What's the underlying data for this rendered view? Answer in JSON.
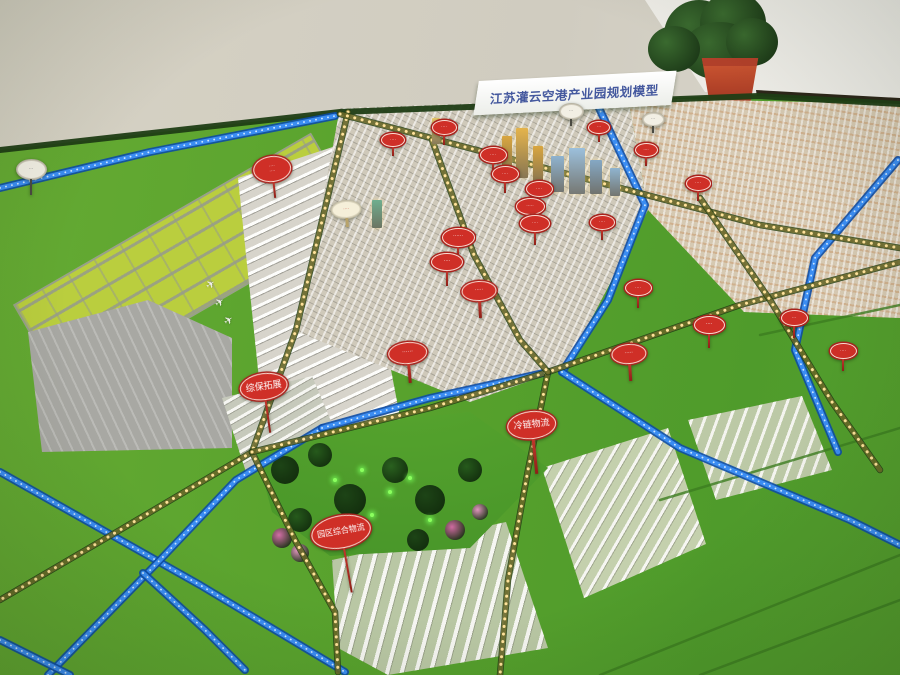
{
  "title_board": {
    "text": "江苏灌云空港产业园规划模型"
  },
  "colors": {
    "grass": "#57a12c",
    "runway_infield": "#bace3e",
    "apron": "#a8a8a3",
    "river_blue": "#3b8df2",
    "road_lights": "#ffe29a",
    "sign_red": "#cf2f27",
    "title_blue": "#44589e",
    "wall": "#d6d2c4",
    "plant_pot": "#b2402a"
  },
  "signs": [
    {
      "x": 272,
      "y": 168,
      "w": 36,
      "h": 24,
      "post": 16,
      "tilt": -6,
      "fs": 4.5,
      "style": "red",
      "text": "····\n····"
    },
    {
      "x": 392,
      "y": 139,
      "w": 22,
      "h": 12,
      "post": 9,
      "tilt": 0,
      "fs": 4.5,
      "style": "red",
      "text": "····"
    },
    {
      "x": 443,
      "y": 126,
      "w": 23,
      "h": 13,
      "post": 10,
      "tilt": 0,
      "fs": 4.5,
      "style": "red",
      "text": "····"
    },
    {
      "x": 492,
      "y": 154,
      "w": 25,
      "h": 14,
      "post": 11,
      "tilt": 0,
      "fs": 4.5,
      "style": "red",
      "text": "····"
    },
    {
      "x": 504,
      "y": 173,
      "w": 25,
      "h": 14,
      "post": 11,
      "tilt": 0,
      "fs": 4.5,
      "style": "red",
      "text": "····"
    },
    {
      "x": 538,
      "y": 188,
      "w": 25,
      "h": 14,
      "post": 10,
      "tilt": 0,
      "fs": 4.5,
      "style": "red",
      "text": "····"
    },
    {
      "x": 529,
      "y": 205,
      "w": 27,
      "h": 15,
      "post": 12,
      "tilt": 0,
      "fs": 4.5,
      "style": "red",
      "text": "·····"
    },
    {
      "x": 534,
      "y": 222,
      "w": 28,
      "h": 15,
      "post": 13,
      "tilt": 0,
      "fs": 4.5,
      "style": "red",
      "text": "····"
    },
    {
      "x": 457,
      "y": 236,
      "w": 31,
      "h": 17,
      "post": 15,
      "tilt": 0,
      "fs": 5,
      "style": "red",
      "text": "······"
    },
    {
      "x": 446,
      "y": 261,
      "w": 30,
      "h": 16,
      "post": 15,
      "tilt": 0,
      "fs": 5,
      "style": "red",
      "text": "····"
    },
    {
      "x": 478,
      "y": 290,
      "w": 33,
      "h": 18,
      "post": 17,
      "tilt": -3,
      "fs": 5,
      "style": "red",
      "text": "·····"
    },
    {
      "x": 407,
      "y": 352,
      "w": 37,
      "h": 20,
      "post": 19,
      "tilt": -5,
      "fs": 5.5,
      "style": "red",
      "text": "······"
    },
    {
      "x": 598,
      "y": 126,
      "w": 20,
      "h": 11,
      "post": 8,
      "tilt": 0,
      "fs": 4,
      "style": "red",
      "text": "···"
    },
    {
      "x": 645,
      "y": 149,
      "w": 21,
      "h": 12,
      "post": 9,
      "tilt": 0,
      "fs": 4,
      "style": "red",
      "text": "····"
    },
    {
      "x": 697,
      "y": 182,
      "w": 23,
      "h": 13,
      "post": 10,
      "tilt": 0,
      "fs": 4.5,
      "style": "red",
      "text": "····"
    },
    {
      "x": 601,
      "y": 221,
      "w": 23,
      "h": 13,
      "post": 10,
      "tilt": 0,
      "fs": 4.5,
      "style": "red",
      "text": "····"
    },
    {
      "x": 637,
      "y": 287,
      "w": 25,
      "h": 14,
      "post": 12,
      "tilt": 0,
      "fs": 4.5,
      "style": "red",
      "text": "····"
    },
    {
      "x": 628,
      "y": 353,
      "w": 33,
      "h": 18,
      "post": 17,
      "tilt": -4,
      "fs": 5,
      "style": "red",
      "text": "·····"
    },
    {
      "x": 708,
      "y": 324,
      "w": 29,
      "h": 16,
      "post": 14,
      "tilt": 0,
      "fs": 5,
      "style": "red",
      "text": "····"
    },
    {
      "x": 793,
      "y": 317,
      "w": 25,
      "h": 14,
      "post": 12,
      "tilt": 0,
      "fs": 4.5,
      "style": "red",
      "text": "···"
    },
    {
      "x": 842,
      "y": 350,
      "w": 25,
      "h": 14,
      "post": 12,
      "tilt": 0,
      "fs": 4.5,
      "style": "red",
      "text": "····"
    },
    {
      "x": 265,
      "y": 385,
      "w": 46,
      "h": 25,
      "post": 33,
      "tilt": -8,
      "fs": 9,
      "style": "red",
      "text": "综保拓展"
    },
    {
      "x": 532,
      "y": 424,
      "w": 47,
      "h": 26,
      "post": 35,
      "tilt": -6,
      "fs": 9,
      "style": "red",
      "text": "冷链物流"
    },
    {
      "x": 344,
      "y": 530,
      "w": 58,
      "h": 31,
      "post": 45,
      "tilt": -10,
      "fs": 8,
      "style": "red",
      "text": "园区综合物流"
    },
    {
      "x": 30,
      "y": 168,
      "w": 27,
      "h": 17,
      "post": 16,
      "tilt": 0,
      "fs": 4.5,
      "style": "pale",
      "text": "···"
    },
    {
      "x": 345,
      "y": 208,
      "w": 27,
      "h": 15,
      "post": 9,
      "tilt": -4,
      "fs": 4.5,
      "style": "pale-red",
      "text": "····"
    },
    {
      "x": 570,
      "y": 110,
      "w": 21,
      "h": 13,
      "post": 7,
      "tilt": 0,
      "fs": 4,
      "style": "pale",
      "text": "···"
    },
    {
      "x": 652,
      "y": 118,
      "w": 19,
      "h": 11,
      "post": 7,
      "tilt": 0,
      "fs": 4,
      "style": "pale",
      "text": "···"
    }
  ],
  "towers": [
    {
      "x": 502,
      "y": 136,
      "w": 10,
      "h": 40,
      "c": "#d9a63f"
    },
    {
      "x": 516,
      "y": 128,
      "w": 12,
      "h": 50,
      "c": "#e5b44c"
    },
    {
      "x": 533,
      "y": 146,
      "w": 10,
      "h": 38,
      "c": "#d9a63f"
    },
    {
      "x": 432,
      "y": 118,
      "w": 8,
      "h": 26,
      "c": "#e8c86a"
    },
    {
      "x": 372,
      "y": 200,
      "w": 10,
      "h": 28,
      "c": "#6fae8f"
    },
    {
      "x": 551,
      "y": 156,
      "w": 13,
      "h": 36,
      "c": "#8fb3cf"
    },
    {
      "x": 569,
      "y": 148,
      "w": 16,
      "h": 46,
      "c": "#9cc0dc"
    },
    {
      "x": 590,
      "y": 160,
      "w": 12,
      "h": 34,
      "c": "#85a8c4"
    },
    {
      "x": 610,
      "y": 168,
      "w": 10,
      "h": 28,
      "c": "#90b4cf"
    }
  ],
  "planes": [
    {
      "x": 206,
      "y": 278
    },
    {
      "x": 215,
      "y": 296
    },
    {
      "x": 224,
      "y": 314
    }
  ],
  "park": {
    "trees": [
      {
        "x": 285,
        "y": 470,
        "r": 14,
        "c": "#1d4416"
      },
      {
        "x": 320,
        "y": 455,
        "r": 12,
        "c": "#265a1c"
      },
      {
        "x": 350,
        "y": 500,
        "r": 16,
        "c": "#1d4416"
      },
      {
        "x": 395,
        "y": 470,
        "r": 13,
        "c": "#2a611f"
      },
      {
        "x": 430,
        "y": 500,
        "r": 15,
        "c": "#1d4416"
      },
      {
        "x": 470,
        "y": 470,
        "r": 12,
        "c": "#265a1c"
      },
      {
        "x": 300,
        "y": 520,
        "r": 12,
        "c": "#265a1c"
      },
      {
        "x": 418,
        "y": 540,
        "r": 11,
        "c": "#1d4416"
      },
      {
        "x": 282,
        "y": 538,
        "r": 10,
        "c": "#d36fa6"
      },
      {
        "x": 300,
        "y": 553,
        "r": 9,
        "c": "#e196be"
      },
      {
        "x": 455,
        "y": 530,
        "r": 10,
        "c": "#cf6ba1"
      },
      {
        "x": 480,
        "y": 512,
        "r": 8,
        "c": "#e196be"
      }
    ],
    "lights": [
      {
        "x": 335,
        "y": 480
      },
      {
        "x": 362,
        "y": 470
      },
      {
        "x": 390,
        "y": 492
      },
      {
        "x": 372,
        "y": 515
      },
      {
        "x": 410,
        "y": 478
      },
      {
        "x": 430,
        "y": 520
      },
      {
        "x": 352,
        "y": 535
      }
    ]
  },
  "roads": {
    "edge_hedge": [
      [
        0,
        150
      ],
      [
        340,
        112
      ],
      [
        758,
        96
      ],
      [
        900,
        104
      ]
    ],
    "gold": [
      [
        [
          348,
          112
        ],
        [
          296,
          330
        ],
        [
          252,
          452
        ]
      ],
      [
        [
          252,
          452
        ],
        [
          120,
          530
        ],
        [
          0,
          600
        ]
      ],
      [
        [
          252,
          452
        ],
        [
          295,
          540
        ],
        [
          335,
          612
        ],
        [
          338,
          672
        ]
      ],
      [
        [
          340,
          114
        ],
        [
          560,
          172
        ],
        [
          760,
          225
        ],
        [
          900,
          248
        ]
      ],
      [
        [
          252,
          452
        ],
        [
          430,
          408
        ],
        [
          548,
          372
        ],
        [
          740,
          305
        ],
        [
          900,
          262
        ]
      ],
      [
        [
          548,
          372
        ],
        [
          528,
          470
        ],
        [
          508,
          580
        ],
        [
          500,
          675
        ]
      ],
      [
        [
          700,
          198
        ],
        [
          770,
          300
        ],
        [
          832,
          402
        ],
        [
          880,
          470
        ]
      ],
      [
        [
          432,
          140
        ],
        [
          474,
          255
        ],
        [
          520,
          340
        ],
        [
          548,
          372
        ]
      ]
    ],
    "blue": [
      [
        [
          0,
          472
        ],
        [
          200,
          585
        ],
        [
          345,
          672
        ]
      ],
      [
        [
          48,
          675
        ],
        [
          160,
          560
        ],
        [
          236,
          480
        ],
        [
          322,
          428
        ]
      ],
      [
        [
          143,
          573
        ],
        [
          205,
          630
        ],
        [
          245,
          670
        ]
      ],
      [
        [
          0,
          640
        ],
        [
          70,
          675
        ]
      ],
      [
        [
          322,
          428
        ],
        [
          430,
          398
        ],
        [
          548,
          372
        ]
      ],
      [
        [
          0,
          188
        ],
        [
          150,
          152
        ],
        [
          335,
          116
        ]
      ],
      [
        [
          598,
          106
        ],
        [
          645,
          205
        ],
        [
          608,
          300
        ],
        [
          562,
          372
        ]
      ],
      [
        [
          562,
          372
        ],
        [
          680,
          448
        ],
        [
          850,
          520
        ],
        [
          900,
          545
        ]
      ],
      [
        [
          898,
          160
        ],
        [
          815,
          258
        ],
        [
          795,
          350
        ],
        [
          838,
          452
        ]
      ]
    ],
    "field_lines": [
      [
        [
          600,
          675
        ],
        [
          900,
          555
        ]
      ],
      [
        [
          660,
          500
        ],
        [
          900,
          428
        ]
      ],
      [
        [
          700,
          675
        ],
        [
          900,
          600
        ]
      ],
      [
        [
          760,
          335
        ],
        [
          900,
          305
        ]
      ]
    ]
  }
}
